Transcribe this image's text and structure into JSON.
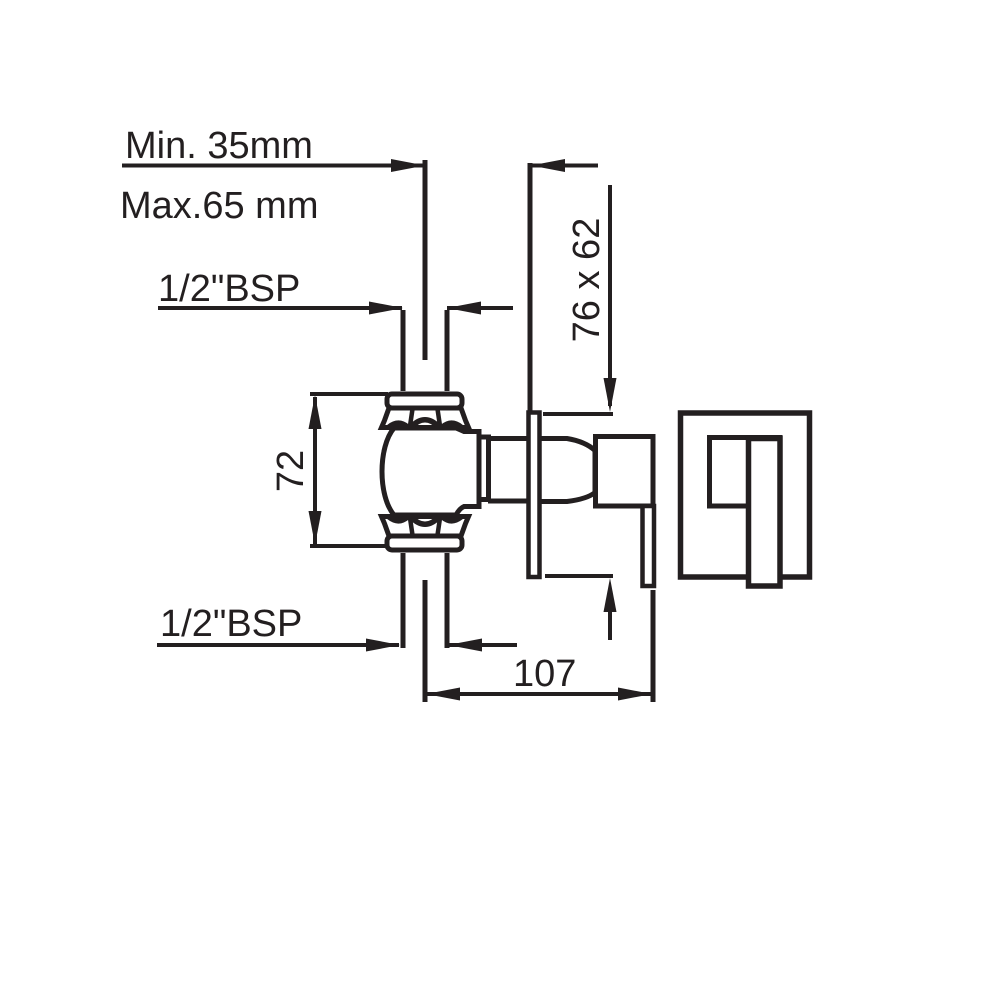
{
  "drawing": {
    "labels": {
      "min_depth": "Min. 35mm",
      "max_depth": "Max.65 mm",
      "thread_top": "1/2\"BSP",
      "thread_bottom": "1/2\"BSP",
      "plate_size": "76 x 62",
      "body_height": "72",
      "projection": "107"
    },
    "colors": {
      "line": "#231f20",
      "background": "#ffffff"
    }
  }
}
